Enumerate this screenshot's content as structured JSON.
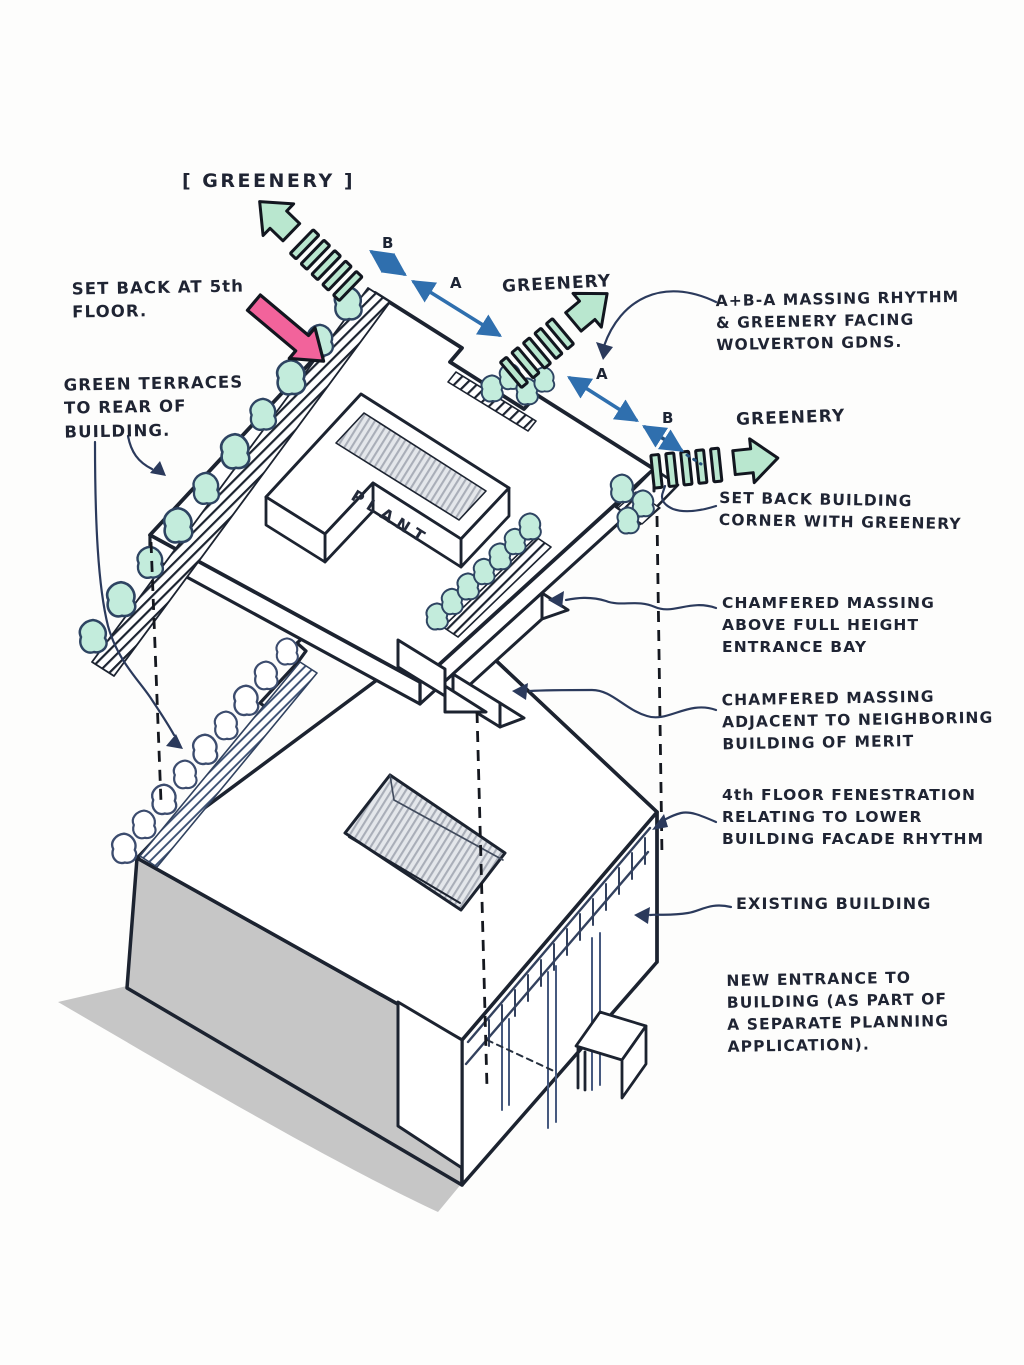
{
  "labels": {
    "greenery_top": "[ GREENERY ]",
    "greenery_mid": "GREENERY",
    "greenery_right": "GREENERY",
    "plant": "PLANT"
  },
  "dimensions": {
    "b1": "B",
    "a1": "A",
    "a2": "A",
    "b2": "B"
  },
  "annotations": {
    "set_back_5th": {
      "lines": [
        "SET BACK AT 5th",
        "FLOOR."
      ]
    },
    "green_terraces": {
      "lines": [
        "GREEN TERRACES",
        "TO REAR OF",
        "BUILDING."
      ]
    },
    "massing_rhythm": {
      "lines": [
        "A+B-A MASSING RHYTHM",
        "& GREENERY FACING",
        "WOLVERTON GDNS."
      ]
    },
    "set_back_corner": {
      "lines": [
        "SET BACK BUILDING",
        "CORNER WITH GREENERY"
      ]
    },
    "chamfered_above": {
      "lines": [
        "CHAMFERED MASSING",
        "ABOVE FULL HEIGHT",
        "ENTRANCE BAY"
      ]
    },
    "chamfered_adjacent": {
      "lines": [
        "CHAMFERED MASSING",
        "ADJACENT TO NEIGHBORING",
        "BUILDING OF MERIT"
      ]
    },
    "fourth_floor": {
      "lines": [
        "4th FLOOR FENESTRATION",
        "RELATING TO LOWER",
        "BUILDING FACADE RHYTHM"
      ]
    },
    "existing_building": {
      "lines": [
        "EXISTING BUILDING"
      ]
    },
    "new_entrance": {
      "lines": [
        "NEW ENTRANCE TO",
        "BUILDING (AS PART OF",
        "A SEPARATE PLANNING",
        "APPLICATION)."
      ]
    }
  },
  "colors": {
    "ink": "#1c2330",
    "leader_ink": "#2b3a5c",
    "dimension_blue": "#2f6fae",
    "greenery_fill": "#b9e7cf",
    "tree_fill": "#c3ecdc",
    "pink_arrow": "#f2639b",
    "shadow_gray": "#c6c6c6",
    "pencil_gray": "#aeb3bd"
  }
}
